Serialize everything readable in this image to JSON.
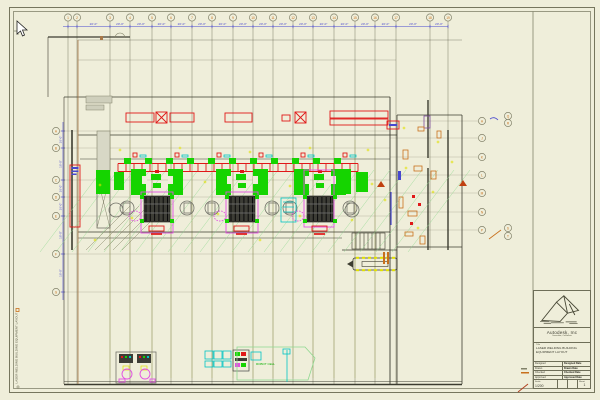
{
  "palette": {
    "paper": "#efeeda",
    "blue": "#4747cf",
    "orange": "#c8701c",
    "red": "#e01818",
    "green": "#15d400",
    "palegreen": "#8fd88f",
    "magenta": "#e24fe2",
    "cyan": "#00c4c4",
    "yellow": "#e0e000",
    "brown": "#a87848",
    "olive": "#76765e",
    "dark_wall": "#3c3c30"
  },
  "sheet": {
    "edge_note": "LASER WELDING BUILDING EQUIPMENT LAYOUT",
    "cursor": "pointer-arrow"
  },
  "grid": {
    "top": {
      "dim_label": "20'-0\"",
      "columns": [
        {
          "label": "1",
          "x": 68
        },
        {
          "label": "2",
          "x": 77
        },
        {
          "label": "3",
          "x": 110
        },
        {
          "label": "4",
          "x": 130
        },
        {
          "label": "5",
          "x": 152
        },
        {
          "label": "6",
          "x": 171
        },
        {
          "label": "7",
          "x": 192
        },
        {
          "label": "8",
          "x": 212
        },
        {
          "label": "9",
          "x": 233
        },
        {
          "label": "10",
          "x": 253
        },
        {
          "label": "11",
          "x": 273
        },
        {
          "label": "12",
          "x": 293
        },
        {
          "label": "13",
          "x": 313
        },
        {
          "label": "14",
          "x": 334
        },
        {
          "label": "15",
          "x": 355
        },
        {
          "label": "16",
          "x": 375
        },
        {
          "label": "17",
          "x": 396
        },
        {
          "label": "18",
          "x": 430,
          "end": 250
        },
        {
          "label": "19",
          "x": 448,
          "end": 250
        }
      ]
    },
    "left": {
      "dim_label": "16'-0\"",
      "rows": [
        {
          "label": "A",
          "y": 131
        },
        {
          "label": "B",
          "y": 148
        },
        {
          "label": "C",
          "y": 180
        },
        {
          "label": "D",
          "y": 197
        },
        {
          "label": "E",
          "y": 216
        },
        {
          "label": "F",
          "y": 254
        },
        {
          "label": "G",
          "y": 292
        }
      ]
    },
    "right": {
      "rows": [
        {
          "label": "H",
          "y": 121
        },
        {
          "label": "J",
          "y": 138
        },
        {
          "label": "K",
          "y": 157
        },
        {
          "label": "L",
          "y": 175
        },
        {
          "label": "M",
          "y": 193
        },
        {
          "label": "N",
          "y": 212
        },
        {
          "label": "P",
          "y": 230
        }
      ],
      "pairs": [
        {
          "label": "Q",
          "y": 116
        },
        {
          "label": "R",
          "y": 123
        },
        {
          "label": "S",
          "y": 228
        },
        {
          "label": "T",
          "y": 236
        }
      ]
    }
  },
  "machines": {
    "stations": [
      {
        "x": 157
      },
      {
        "x": 242
      },
      {
        "x": 320,
        "tall": true
      }
    ],
    "bottom_label": "ROBOT CELL"
  },
  "title_block": {
    "company": "Autodesk, Inc",
    "address": "Sausalito, California",
    "title_label": "Title",
    "title_line1": "LASER WELDING BUILDING",
    "title_line2": "EQUIPMENT LAYOUT",
    "fields": [
      {
        "label": "Designed",
        "date_label": "Designed Date"
      },
      {
        "label": "Drawn",
        "date_label": "Drawn Date"
      },
      {
        "label": "Checked",
        "date_label": "Checked Date"
      },
      {
        "label": "Approved",
        "date_label": "Approved Date"
      }
    ],
    "scale_label": "Scale",
    "scale_value": "1/200",
    "sheet_label": "Sheet",
    "sheet_value": "1"
  }
}
